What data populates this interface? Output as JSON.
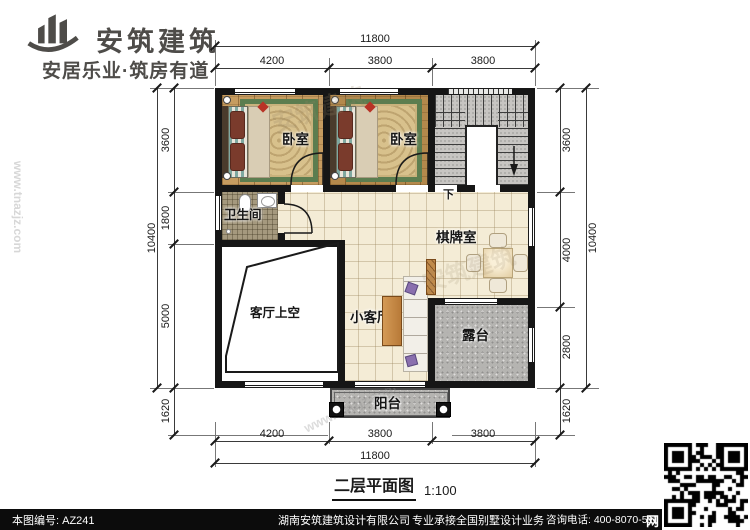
{
  "header": {
    "brand": "安筑建筑",
    "tagline": "安居乐业·筑房有道"
  },
  "plan": {
    "rooms": {
      "bedroom1": "卧室",
      "bedroom2": "卧室",
      "bathroom": "卫生间",
      "chess_room": "棋牌室",
      "living_void": "客厅上空",
      "small_living": "小客厅",
      "terrace": "露台",
      "balcony": "阳台"
    },
    "stair_down": "下"
  },
  "dims": {
    "top": {
      "overall": "11800",
      "segments": [
        "4200",
        "3800",
        "3800"
      ]
    },
    "bottom": {
      "overall": "11800",
      "segments": [
        "4200",
        "3800",
        "3800"
      ]
    },
    "left": {
      "overall": "10400",
      "segments": [
        "3600",
        "1800",
        "5000"
      ],
      "offset": "1620"
    },
    "right": {
      "overall": "10400",
      "segments": [
        "3600",
        "4000",
        "2800"
      ],
      "offset": "1620"
    }
  },
  "title": {
    "text": "二层平面图",
    "scale": "1:100"
  },
  "footer": {
    "drawing_no": "本图编号: AZ241",
    "company": "湖南安筑建筑设计有限公司",
    "service": "专业承接全国别墅设计业务",
    "phone": "咨询电话: 400-8070-511",
    "web_char": "网"
  },
  "watermark": {
    "text": "安筑建筑",
    "url": "www.tnazjz.com"
  },
  "colors": {
    "wall": "#161616",
    "tile_floor": "#f4ecd6",
    "wood_floor": "#c69c60",
    "stone": "#b5b4b1",
    "rug_green": "#5c7d4f",
    "footer_bar": "#0c0c0c",
    "brand_gray": "#4e4c49"
  }
}
